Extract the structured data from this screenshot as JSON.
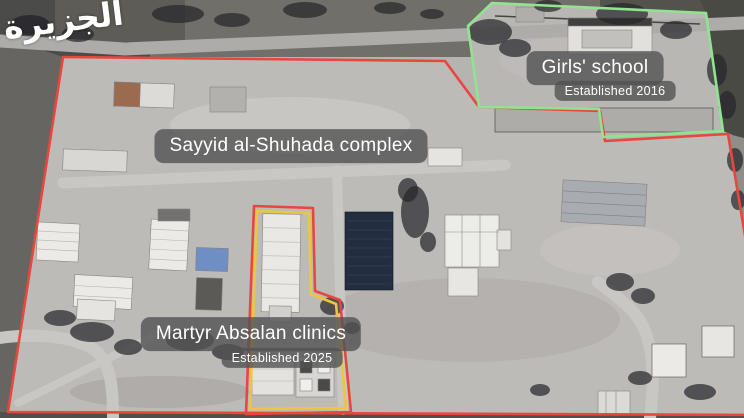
{
  "branding": {
    "logo_arabic": "الجزيرة"
  },
  "colors": {
    "complex_outline": "#e8473d",
    "school_outline": "#90e48f",
    "clinics_outline_outer": "#e8473d",
    "clinics_outline_inner": "#ecc63e"
  },
  "annotations": {
    "complex": {
      "label": "Sayyid al-Shuhada complex"
    },
    "school": {
      "label": "Girls' school",
      "established": "Established 2016"
    },
    "clinics": {
      "label": "Martyr Absalan clinics",
      "established": "Established 2025"
    }
  }
}
